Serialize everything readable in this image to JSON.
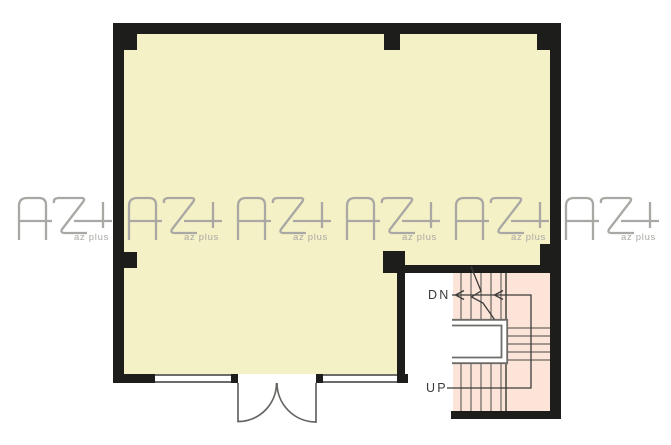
{
  "labels": {
    "down": "DN",
    "up": "UP"
  },
  "watermark": {
    "logo_text": "AZ+",
    "subtext": "az plus",
    "count": 6
  },
  "colors": {
    "background": "#ffffff",
    "room_fill": "#f5f1c6",
    "stair_fill": "#fce4d9",
    "wall": "#1d1d1b",
    "stair_line": "#6b6760",
    "detail_line": "#3c3c3a",
    "island_line": "#6e6c68",
    "door_line": "#666461",
    "watermark": "#a9a8a4",
    "label_text": "#3a3a38"
  }
}
